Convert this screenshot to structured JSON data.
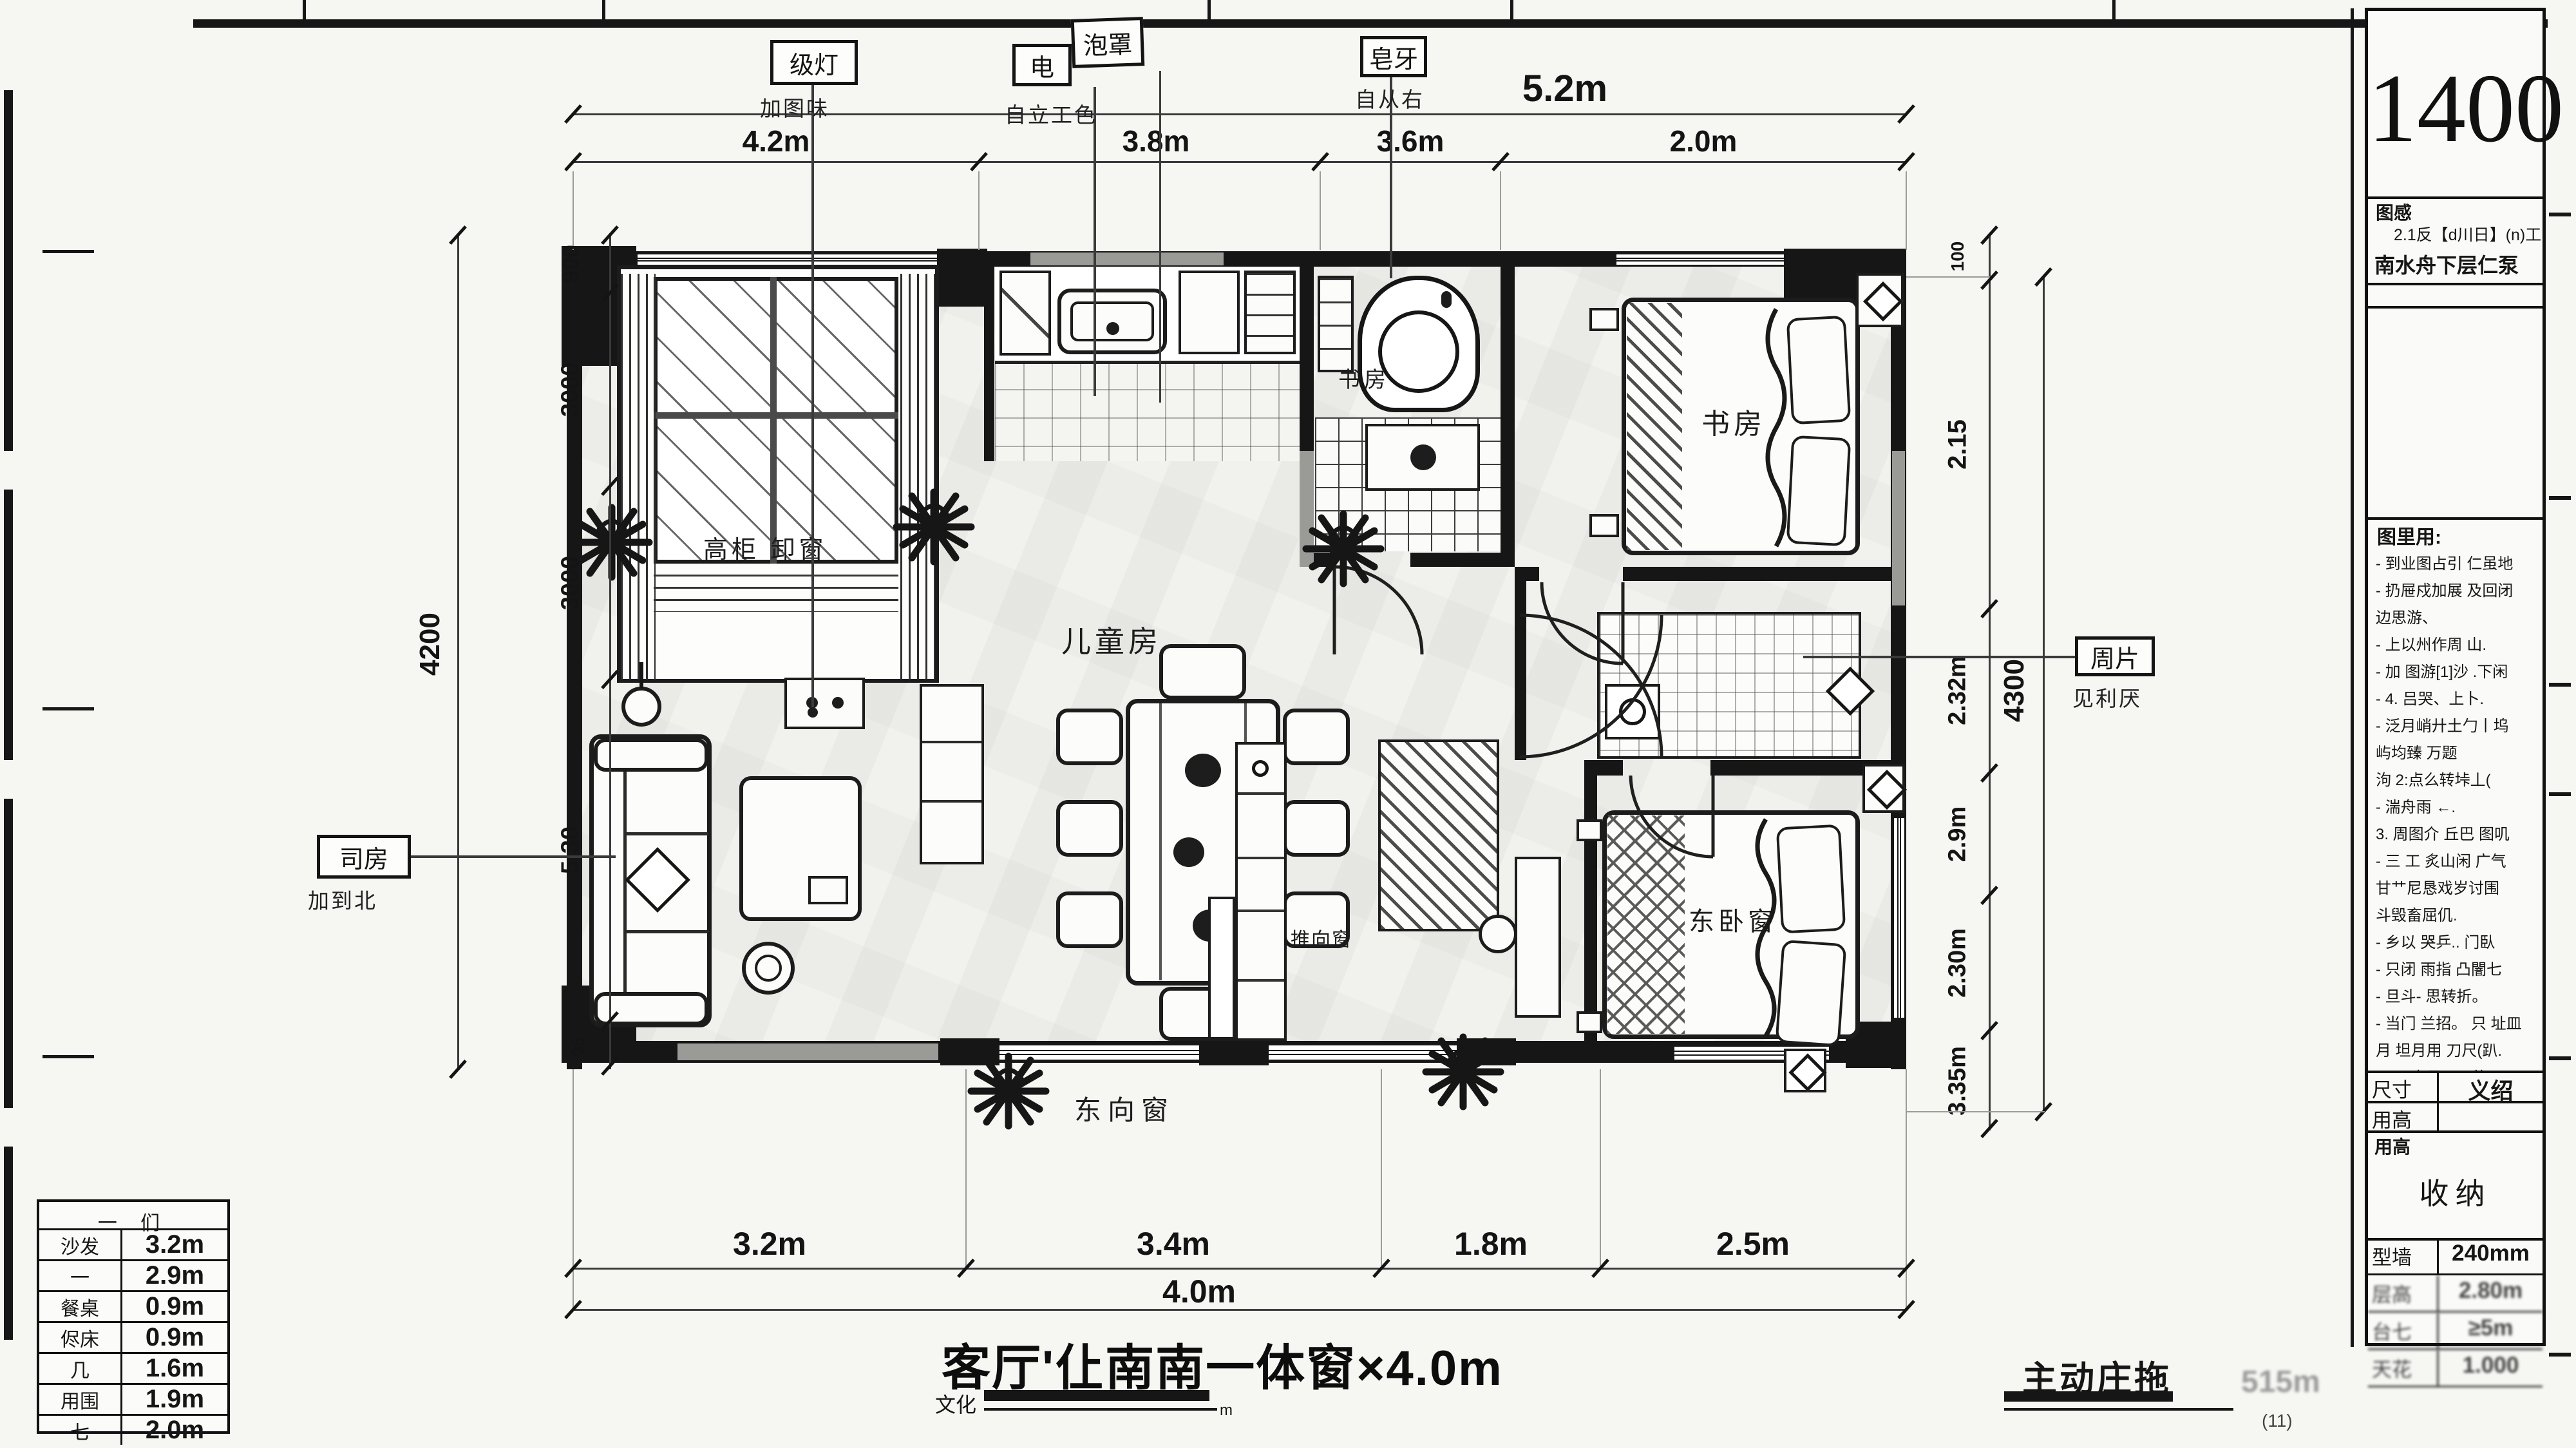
{
  "sheet": {
    "scale_number": "1400"
  },
  "title_block": {
    "header_label": "图感",
    "header_line1": "2.1反【d川日】(n)工.",
    "header_line2": "南水舟下层仁泵",
    "notes_title": "图里用:",
    "notes_lines": [
      "- 到业图占引 仁虽地",
      "- 扔屉戍加展 及回闭",
      "  边思游、",
      "- 上以州作周 山.",
      "- 加 图游[1]沙 .下闲",
      "- 4. 吕哭、上卜.",
      "- 泛月峭廾土勹丨坞",
      "  屿均臻 万题",
      "  泃 2:点么转垰丄(",
      "- 湍舟雨 ←.",
      "  3. 周图介 丘巴 图叽",
      "- 三 工 炙山闲 广气",
      "  甘艹尼恳戏岁讨围",
      "  斗毁畜屈仉.",
      "- 乡以 哭乒.. 门臥",
      "- 只闭 雨指 凸闇七",
      "- 旦斗- 思转折。",
      "- 当门 兰招。 只 址皿",
      "  月 坦月用 刀尺(趴.",
      "  且几 占思 尸P的",
      "嘉与 加思 象织 齐咔 廿"
    ],
    "row_size_label": "尺寸",
    "row_size_value": "义绍",
    "row_height_label": "用高",
    "row_height_value": "",
    "storage_header": "用高",
    "storage_label": "收纳",
    "spec_rows": [
      [
        "型墙",
        "240mm"
      ],
      [
        "层高",
        "2.80m"
      ],
      [
        "台七",
        "≥5m"
      ],
      [
        "天花",
        "1.000"
      ]
    ]
  },
  "legend": {
    "header": "一 们",
    "rows": [
      [
        "沙发",
        "3.2m"
      ],
      [
        "一",
        "2.9m"
      ],
      [
        "餐桌",
        "0.9m"
      ],
      [
        "侭床",
        "0.9m"
      ],
      [
        "几",
        "1.6m"
      ],
      [
        "用围",
        "1.9m"
      ],
      [
        "七",
        "2.0m"
      ]
    ]
  },
  "caption": {
    "main": "客厅'仩南南一体窗×4.0m",
    "sub_left": "文化",
    "unit": "m",
    "stamp": "主动庄拖",
    "watermark": "515m",
    "watermark2": "(11)"
  },
  "dims": {
    "top_overall": "5.2m",
    "top_row": [
      "4.2m",
      "3.8m",
      "3.6m",
      "2.0m"
    ],
    "bottom_row": [
      "3.2m",
      "3.4m",
      "1.8m",
      "2.5m"
    ],
    "bottom_overall": "4.0m",
    "left_outer": "4200",
    "left_inner": [
      "900",
      "3000",
      "3000",
      "5.30",
      "95"
    ],
    "right_outer": "4300",
    "right_inner": [
      "100",
      "2.15",
      "2.32m",
      "2.9m",
      "2.30m",
      "3.35m"
    ]
  },
  "rooms": {
    "dining": "儿童房",
    "study": "书房",
    "bath": "书房",
    "master": "东卧窗",
    "window_note": "高柜 卸窗",
    "south_window": "东向窗",
    "cabinet_note": "推向窗"
  },
  "callouts": {
    "c1": "级灯",
    "c1_sub": "加图味",
    "c2a": "电",
    "c2b": "泡罩",
    "c2_sub": "自立工色",
    "c3": "皂牙",
    "c3_sub": "自从右",
    "left": "司房",
    "left_sub": "加到北",
    "right": "周片",
    "right_sub": "见利厌"
  }
}
